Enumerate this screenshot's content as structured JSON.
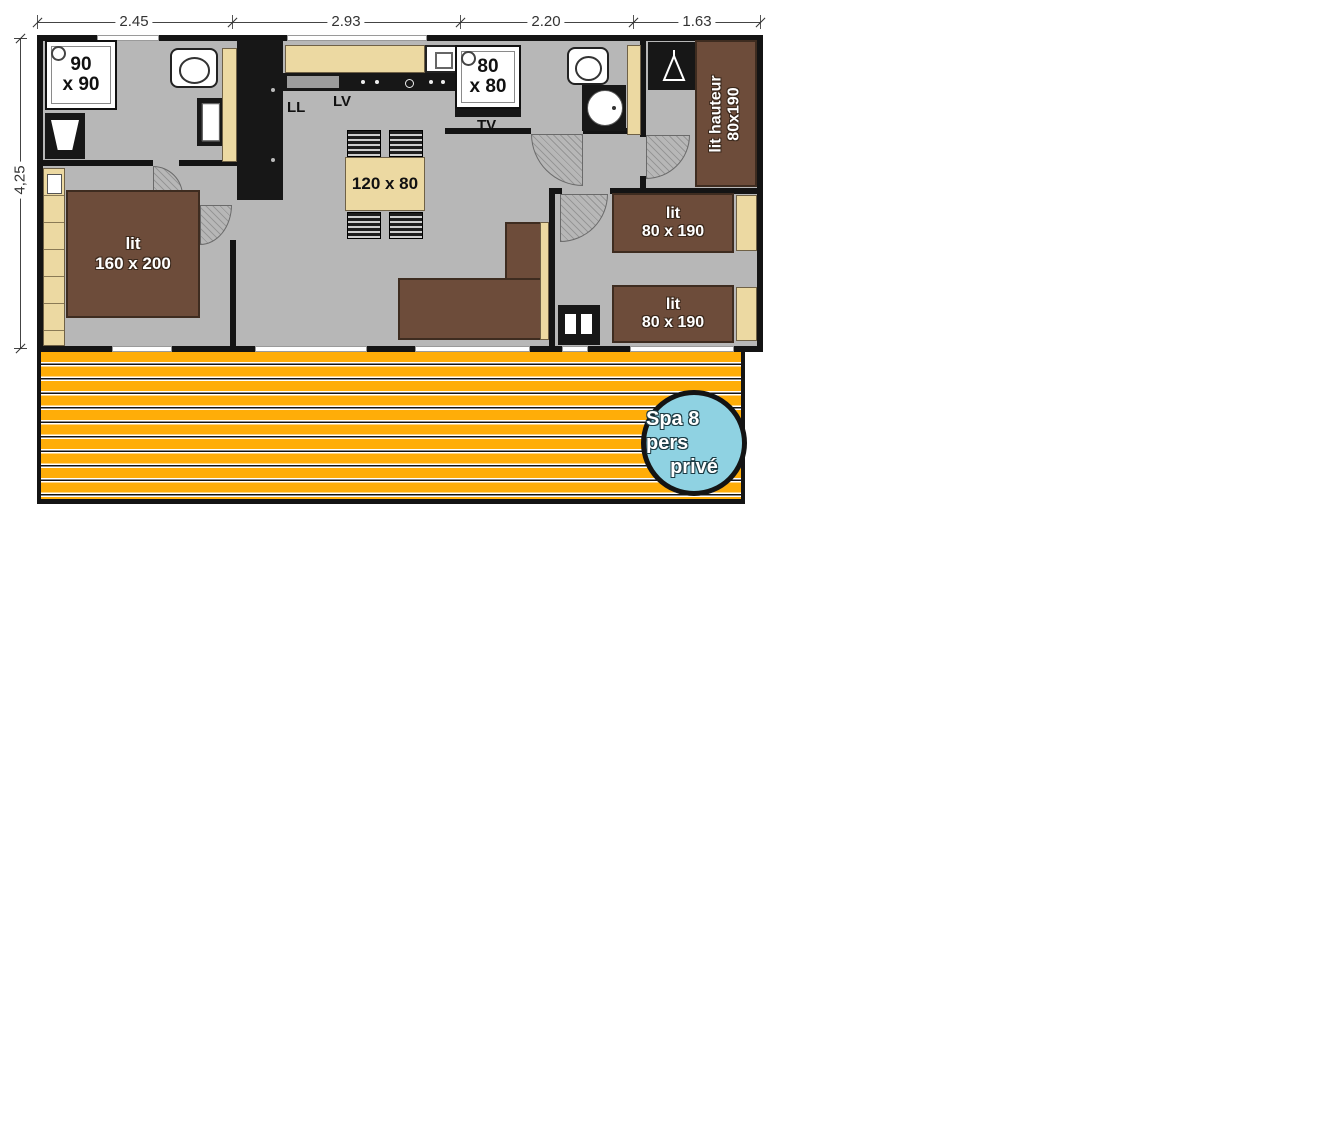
{
  "dims": {
    "top": [
      "2.45",
      "2.93",
      "2.20",
      "1.63"
    ],
    "left": "4,25"
  },
  "labels": {
    "shower_large_l1": "90",
    "shower_large_l2": "x 90",
    "shower_small_l1": "80",
    "shower_small_l2": "x 80",
    "table": "120 x 80",
    "washer": "LL",
    "dishwasher": "LV",
    "tv": "TV",
    "bed_master_l1": "lit",
    "bed_master_l2": "160 x 200",
    "bed_high_l1": "lit hauteur",
    "bed_high_l2": "80x190",
    "bed_single_l1": "lit",
    "bed_single_l2": "80 x 190",
    "spa_l1": "Spa 8 pers",
    "spa_l2": "privé"
  },
  "colors": {
    "floor": "#b7b7b7",
    "wall": "#141414",
    "wood_furniture": "#ecd9a2",
    "bed_brown": "#6d4c3a",
    "deck_orange": "#ffad08",
    "spa_blue": "#8fd2e2"
  }
}
